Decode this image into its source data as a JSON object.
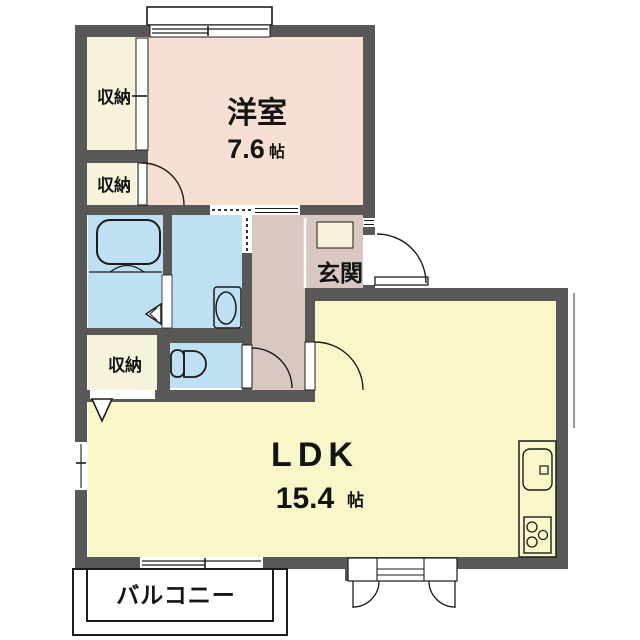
{
  "floorplan": {
    "rooms": {
      "western_room": {
        "label": "洋室",
        "size_value": "7.6",
        "size_unit": "帖"
      },
      "ldk": {
        "label": "LDK",
        "size_value": "15.4",
        "size_unit": "帖"
      },
      "entrance": {
        "label": "玄関"
      },
      "balcony": {
        "label": "バルコニー"
      },
      "closet1": {
        "label": "収納"
      },
      "closet2": {
        "label": "収納"
      },
      "closet3": {
        "label": "収納"
      }
    },
    "fixtures": [
      "bathtub-icon",
      "bath-folding-door-icon",
      "washbasin-icon",
      "toilet-icon",
      "kitchen-sink-icon",
      "gas-stove-icon",
      "door-swing-arc-icon",
      "sliding-door-icon",
      "sliding-window-icon",
      "closet-fold-door-icon"
    ],
    "palette": {
      "wall": "#5a5757",
      "line": "#1c1c1c",
      "western_room": "#f8dfd3",
      "ldk": "#f9f6c9",
      "wet_area": "#bfe0f2",
      "corridor": "#d9c7c1",
      "closet": "#f6f3da",
      "white": "#ffffff"
    }
  }
}
